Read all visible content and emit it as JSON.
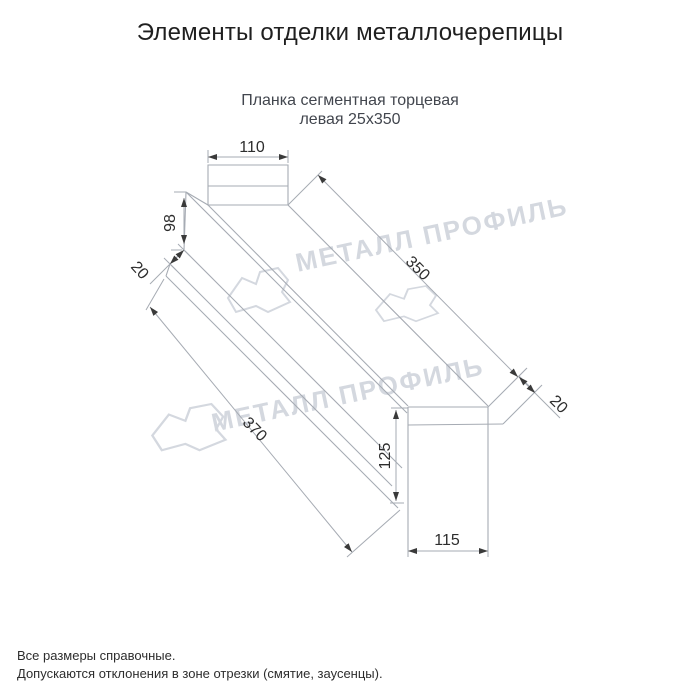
{
  "title": "Элементы отделки металлочерепицы",
  "subtitle": {
    "line1": "Планка сегментная торцевая",
    "line2": "левая 25х350"
  },
  "dimensions": {
    "top_width": "110",
    "left_height": "98",
    "left_fold": "20",
    "top_length": "350",
    "right_fold": "20",
    "bottom_length": "370",
    "right_height": "125",
    "bottom_width": "115"
  },
  "watermark": {
    "text": "МЕТАЛЛ ПРОФИЛЬ",
    "logo": "metall-profil-logo"
  },
  "footnotes": {
    "line1": "Все размеры справочные.",
    "line2": "Допускаются отклонения в зоне отрезки (смятие, заусенцы)."
  },
  "colors": {
    "line": "#a6abb3",
    "dim_arrow": "#3a3a3a",
    "dim_text": "#2d2d2d",
    "watermark": "#d4d8df",
    "title_text": "#1f1f1f",
    "subtitle_text": "#42464e",
    "background": "#ffffff"
  }
}
